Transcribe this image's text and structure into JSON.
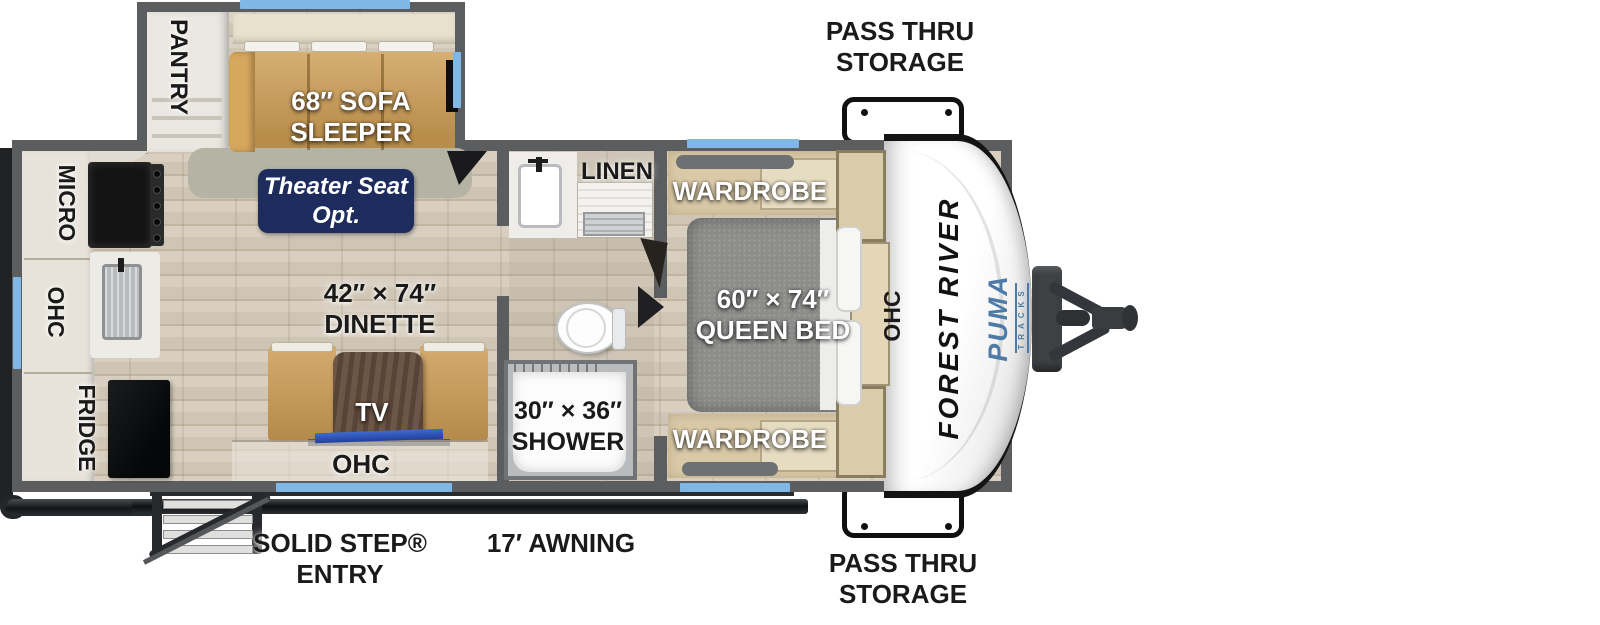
{
  "title": "Travel trailer floor plan",
  "brand": {
    "manufacturer": "FOREST RIVER",
    "model": "PUMA",
    "model_sub": "TRACKS"
  },
  "exterior": {
    "pass_thru_top": [
      "PASS THRU",
      "STORAGE"
    ],
    "pass_thru_bottom": [
      "PASS THRU",
      "STORAGE"
    ],
    "entry": [
      "SOLID STEP®",
      "ENTRY"
    ],
    "awning": "17′ AWNING"
  },
  "slideout": {
    "pantry": "PANTRY",
    "sofa": [
      "68″ SOFA",
      "SLEEPER"
    ]
  },
  "living": {
    "theater_opt": [
      "Theater Seat",
      "Opt."
    ],
    "dinette": [
      "42″ × 74″",
      "DINETTE"
    ],
    "tv": "TV",
    "ohc": "OHC"
  },
  "kitchen": {
    "micro": "MICRO",
    "ohc": "OHC",
    "fridge": "FRIDGE"
  },
  "bathroom": {
    "linen": "LINEN",
    "shower": [
      "30″ × 36″",
      "SHOWER"
    ]
  },
  "bedroom": {
    "wardrobe_top": "WARDROBE",
    "wardrobe_bottom": "WARDROBE",
    "bed": [
      "60″ × 74″",
      "QUEEN BED"
    ],
    "ohc": "OHC"
  },
  "colors": {
    "wall": "#5b5d5f",
    "window_blue": "#7fb8e4",
    "badge_navy": "#1d2c5c",
    "sofa_tan": "#cd9d54",
    "puma_blue": "#4d7ba8",
    "floor_light": "#d8cfc1"
  }
}
